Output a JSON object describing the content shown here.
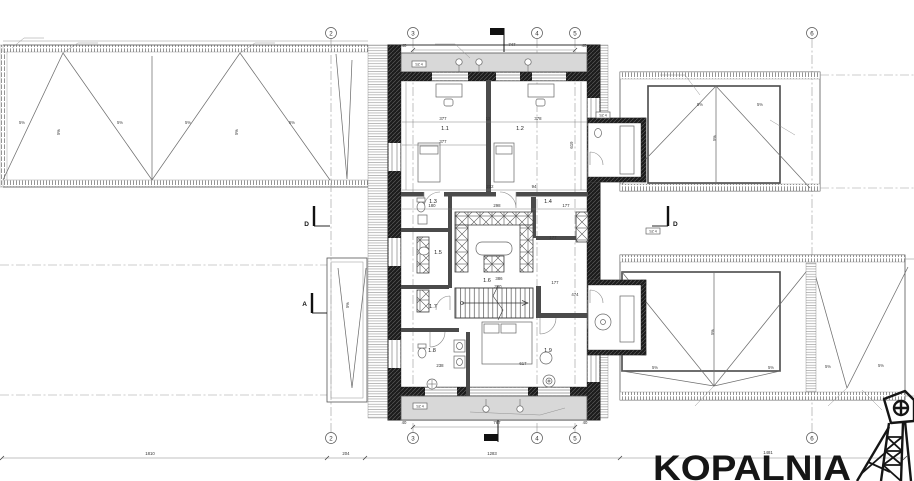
{
  "rooms": {
    "r1": "1.1",
    "r2": "1.2",
    "r3": "1.3",
    "r4": "1.4",
    "r5": "1.5",
    "r6": "1.6",
    "r7": "1.7",
    "r8": "1.8",
    "r9": "1.9"
  },
  "grid": {
    "g2": "2",
    "g3": "3",
    "g4": "4",
    "g5": "5",
    "g6": "6"
  },
  "sections": {
    "a": "A",
    "d": "D"
  },
  "slope": {
    "label": "5%"
  },
  "tags": {
    "lintel": "SZ 4"
  },
  "dims": {
    "d377a": "377",
    "d12": "12",
    "d378": "378",
    "d377b": "377",
    "d619": "619",
    "d180": "180",
    "d232": "232",
    "d94": "94",
    "d298": "298",
    "d177": "177",
    "d386": "386",
    "d380": "380",
    "d474": "474",
    "d617": "617",
    "d238": "238",
    "d747": "747",
    "d767": "767",
    "d40": "40",
    "t1810": "1810",
    "t204": "204",
    "t1283": "1283",
    "t1481": "1481"
  },
  "logo": {
    "brand": "KOPALNIA"
  }
}
